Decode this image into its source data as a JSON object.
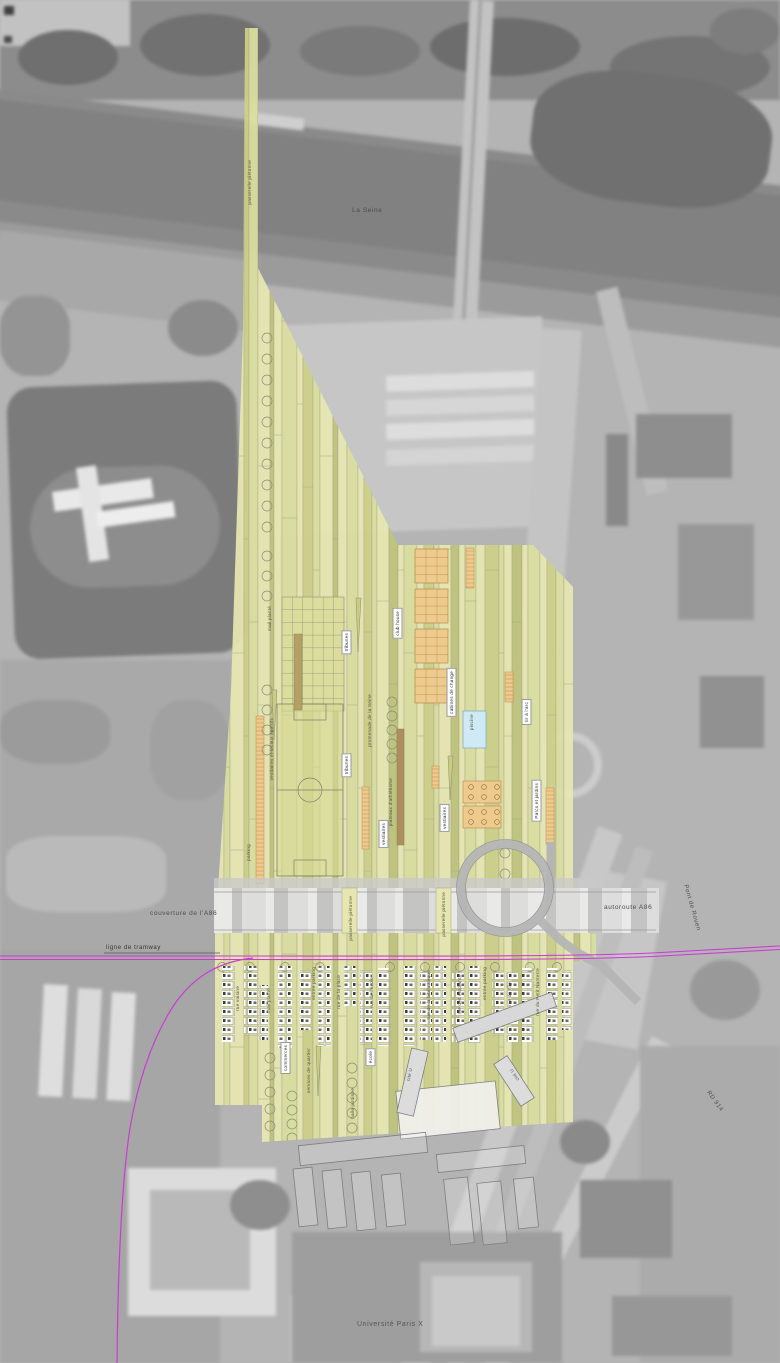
{
  "context_labels": {
    "la_seine": "La Seine",
    "couverture_a86": "couverture de l'A86",
    "ligne_de_tramway": "ligne de tramway",
    "autoroute_a86": "autoroute A86",
    "pont_de_rouen": "Pont de Rouen",
    "universite_paris_x": "Université Paris X",
    "rd_914": "RD 914"
  },
  "plan_labels": {
    "passerelle_pietonne": "passerelle piétonne",
    "mail_plante": "mail planté",
    "tribunes": "tribunes",
    "club_house": "club house",
    "promenade_de_la_seine": "promenade de la Seine",
    "cabines_de_change": "cabines de change",
    "piscine": "piscine",
    "tir_a_larc": "tir à l'arc",
    "vestiaires_et_locaux_sportifs": "vestiaires et locaux sportifs",
    "plateaux_athletisme": "plateaux d'athlétisme",
    "vestiaires": "vestiaires",
    "parking": "parking",
    "parcs_et_jardins": "Parcs et jardins"
  },
  "district_labels": {
    "rue_voisine": "rue voisine",
    "entree_parking": "entrée parking",
    "rue_de_la_place": "rue de la place",
    "rue_de_lecole": "rue de l'école",
    "rue_de_la_bibliotheque": "rue de la bibliothèque",
    "rue_des_etudiants": "rue des étudiants",
    "rue_de_lile": "rue de l'île",
    "rue_du_petit_nanterre": "rue du Petit Nanterre",
    "commerces": "commerces",
    "services_de_quartier": "services de quartier",
    "halle_jardinee": "halle jardinée",
    "ecole": "école",
    "cite_u": "cité U"
  },
  "colors": {
    "plan_base": "#e6e7b0",
    "plan_stripe_mid": "#dcdf9e",
    "plan_stripe_dark": "#cdd189",
    "plan_stripe_olive": "#bec47b",
    "orange_block": "#edca8e",
    "brown_strip": "#ab8f5e",
    "pool_blue": "#cfe9f5",
    "tram_magenta": "#cb3bd4",
    "band_gray": "#d0d0d0",
    "label_ink": "#55553f"
  }
}
